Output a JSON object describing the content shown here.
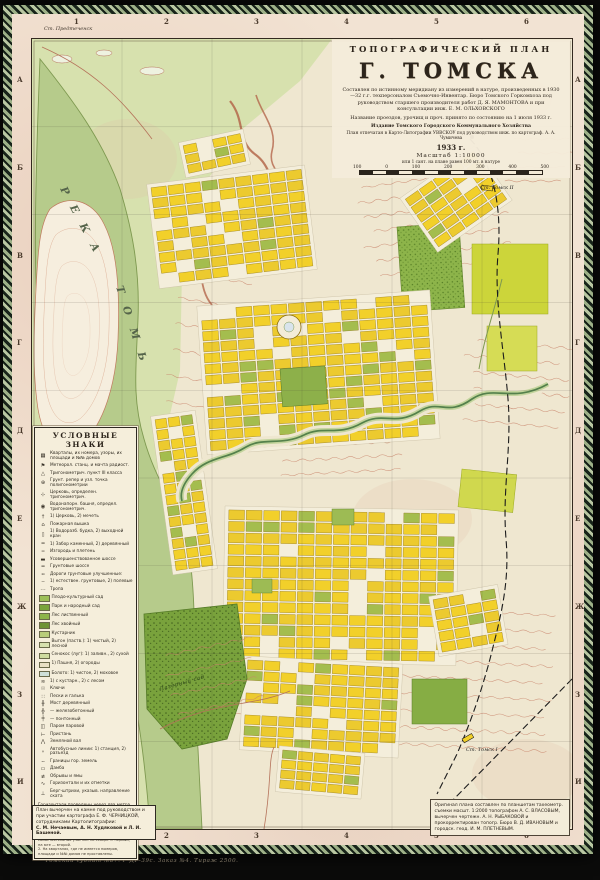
{
  "margin": {
    "top_numbers": [
      "1",
      "2",
      "3",
      "4",
      "5",
      "6"
    ],
    "bottom_numbers": [
      "1",
      "2",
      "3",
      "4",
      "5",
      "6"
    ],
    "left_letters": [
      "А",
      "Б",
      "В",
      "Г",
      "Д",
      "Е",
      "Ж",
      "З",
      "И"
    ],
    "right_letters": [
      "А",
      "Б",
      "В",
      "Г",
      "Д",
      "Е",
      "Ж",
      "З",
      "И"
    ],
    "station_label": "Ст. Предтеченск"
  },
  "title_block": {
    "kicker": "ТОПОГРАФИЧЕСКИЙ  ПЛАН",
    "title": "Г. ТОМСКА",
    "para1": "Составлен по истинному меридиану из измерений в натуре, произведенных в 1930—32 г.г. техперсоналом Съемочно-Инвентар. Бюро Томского Горкомхоза под руководством старшего производителя работ Д. Я. МАМОНТОВА и при консультации инж. Е. М. ОЛЬХОВСКОГО",
    "para2": "Название проездов, урочищ и проч. принято по состоянию на 1 июля 1933 г.",
    "publisher": "Издание Томского Городского Коммунального Хозяйства",
    "print_note": "План отпечатан в Карто-Литографии УВВСКОУ под руководством инж. по картограф. А. А. Чумичева",
    "year": "1933 г.",
    "scale_label": "Масштаб 1:10000",
    "scale_sub": "или 1 сант. на плане равен 100 мт. в натуре",
    "scale_ticks": [
      "100",
      "0",
      "100",
      "200",
      "300",
      "400",
      "500"
    ]
  },
  "legend": {
    "title": "УСЛОВНЫЕ  ЗНАКИ",
    "entries": [
      {
        "icon": "block-grid-icon",
        "glyph": "▦",
        "label": "Кварталы, их номера, узоры, их площади и №№ домов"
      },
      {
        "icon": "meteo-mast-icon",
        "glyph": "⚑",
        "label": "Метеорол. станц. и мачта радиост."
      },
      {
        "icon": "trig-point-icon",
        "glyph": "△",
        "label": "Тригонометрич. пункт III класса"
      },
      {
        "icon": "reper-icon",
        "glyph": "⊕",
        "label": "Грунт. репер и узл. точка полигонометрии"
      },
      {
        "icon": "church-trig-icon",
        "glyph": "⊹",
        "label": "Церковь, определен. тригонометрич."
      },
      {
        "icon": "tower-trig-icon",
        "glyph": "◉",
        "label": "Водонапорн. башня, определ. тригонометрич."
      },
      {
        "icon": "church-icon",
        "glyph": "†",
        "label": "1) Церковь, 2) мечеть"
      },
      {
        "icon": "fire-tower-icon",
        "glyph": "⌂",
        "label": "Пожарная вышка"
      },
      {
        "icon": "hydrant-icon",
        "glyph": "▯",
        "label": "1) Водоразб. будка, 2) выходной кран"
      },
      {
        "icon": "fence-icon",
        "glyph": "═",
        "label": "1) Забор каменный, 2) деревянный"
      },
      {
        "icon": "hedge-icon",
        "glyph": "┅",
        "label": "Изгородь и плетень"
      },
      {
        "icon": "road-paved-icon",
        "glyph": "▬",
        "label": "Усовершенствованное шоссе"
      },
      {
        "icon": "road-gravel-icon",
        "glyph": "━",
        "label": "Грунтовые шоссе"
      },
      {
        "icon": "road-improved-icon",
        "glyph": "╍",
        "label": "Дороги грунтовые улучшенные:"
      },
      {
        "icon": "road-natural-icon",
        "glyph": "┄",
        "label": "1) естествен. грунтовые, 2) полевые"
      },
      {
        "icon": "path-icon",
        "glyph": "⋯",
        "label": "Тропа"
      },
      {
        "icon": "orchard-icon",
        "swatch": "#9dc057",
        "label": "Плодо-культурный сад"
      },
      {
        "icon": "park-icon",
        "swatch": "#7aa43c",
        "label": "Парк и народный сад"
      },
      {
        "icon": "forest-deciduous-icon",
        "swatch": "#8db44a",
        "label": "Лес лиственный"
      },
      {
        "icon": "forest-conifer-icon",
        "swatch": "#6e9335",
        "label": "Лес хвойный"
      },
      {
        "icon": "shrub-icon",
        "swatch": "#b8cc79",
        "label": "Кустарник"
      },
      {
        "icon": "pasture-icon",
        "swatch": "#d7e1ae",
        "label": "Выгон (паств.): 1) чистый, 2) лесной"
      },
      {
        "icon": "meadow-icon",
        "swatch": "#cfdca0",
        "label": "Сенокос (луг): 1) заливн., 2) сухой"
      },
      {
        "icon": "field-icon",
        "swatch": "#e8e0c4",
        "label": "1) Пашня, 2) огороды"
      },
      {
        "icon": "swamp-icon",
        "swatch": "#cfe0d8",
        "label": "Болото: 1) чистое, 2) моховое"
      },
      {
        "icon": "swamp-wooded-icon",
        "glyph": "≋",
        "label": "1) с кустарн., 2) с лесом"
      },
      {
        "icon": "springs-icon",
        "glyph": "☉",
        "label": "Ключи"
      },
      {
        "icon": "sand-icon",
        "glyph": "∷",
        "label": "Пески и галька"
      },
      {
        "icon": "bridge-wood-icon",
        "glyph": "╫",
        "label": "Мост деревянный"
      },
      {
        "icon": "bridge-concrete-icon",
        "glyph": "╬",
        "label": "—  железобетонный"
      },
      {
        "icon": "bridge-pontoon-icon",
        "glyph": "╪",
        "label": "—  понтонный"
      },
      {
        "icon": "ferry-icon",
        "glyph": "◫",
        "label": "Паром паровой"
      },
      {
        "icon": "pier-icon",
        "glyph": "⊢",
        "label": "Пристань"
      },
      {
        "icon": "rampart-icon",
        "glyph": "⋀",
        "label": "Земляной вал"
      },
      {
        "icon": "bus-line-icon",
        "glyph": "∘",
        "label": "Автобусные линии: 1) станция, 2) разъезд"
      },
      {
        "icon": "boundary-icon",
        "glyph": "╌",
        "label": "Границы гор. земель"
      },
      {
        "icon": "dam-icon",
        "glyph": "▭",
        "label": "Дамба"
      },
      {
        "icon": "cliff-icon",
        "glyph": "≢",
        "label": "Обрывы и ямы"
      },
      {
        "icon": "contour-icon",
        "glyph": "∿",
        "label": "Горизонтали и их отметки"
      },
      {
        "icon": "bergstrich-icon",
        "glyph": "⊥",
        "label": "Берг-штрихи, указыв. направление ската"
      }
    ],
    "notes": [
      "Горизонтали проведены через два метра по высоте",
      "Горизонтали кратные десяти утолщены",
      "Горизонтали пунктирные — половинные, проведенные через 1 метр по высоте"
    ],
    "fine_notes": [
      "1. Г. Томск делится р. Ушайкой на 2 самостоятельных участка: на севере — первый, на юге — второй.",
      "2. На кварталах, где не имеется номеров, площади и №№ домов не проставлены."
    ]
  },
  "credits_left": {
    "p1": "План вычерчен на камне под руководством и при участии картографа Е. Ф. ЧЕРНИЦКОЙ, сотрудниками Картолитографии:",
    "p2": "С. М. Нечаевым, А. Н. Худяковой и Л. И. Башеной."
  },
  "credits_right": {
    "p1": "Оригинал плана составлен по планшетам тахеометр. съемки масшт. 1:2000 топографом А. С. ВЛАСОВЫМ, вычерчен чертежн. А. Н. РЫБАКОВОЙ и прокорректирован топогр. Бюро В. Д. ИВАНОВЫМ и городск. геод. И. М. ПЛЕТНЕВЫМ."
  },
  "imprint": "Томский гублит №87.  Р-ДР-39с.  Заказ №4.  Тираж 2500.",
  "map_labels": [
    {
      "text": "Р  Е  К  А"
    },
    {
      "text": "Т  О  М  Ь"
    },
    {
      "text": "Ст. Томск II"
    },
    {
      "text": "Ст. Томск I"
    },
    {
      "text": "Лагерный сад"
    }
  ],
  "colors": {
    "paper": "#f2e3d3",
    "map_base": "#efe7d0",
    "floodplain": "#d7e1ae",
    "water": "#b6cb8b",
    "blocks": "#f2d02a",
    "forest": "#8db44a",
    "contours": "#c8836a",
    "border_weave": "#18241a"
  }
}
